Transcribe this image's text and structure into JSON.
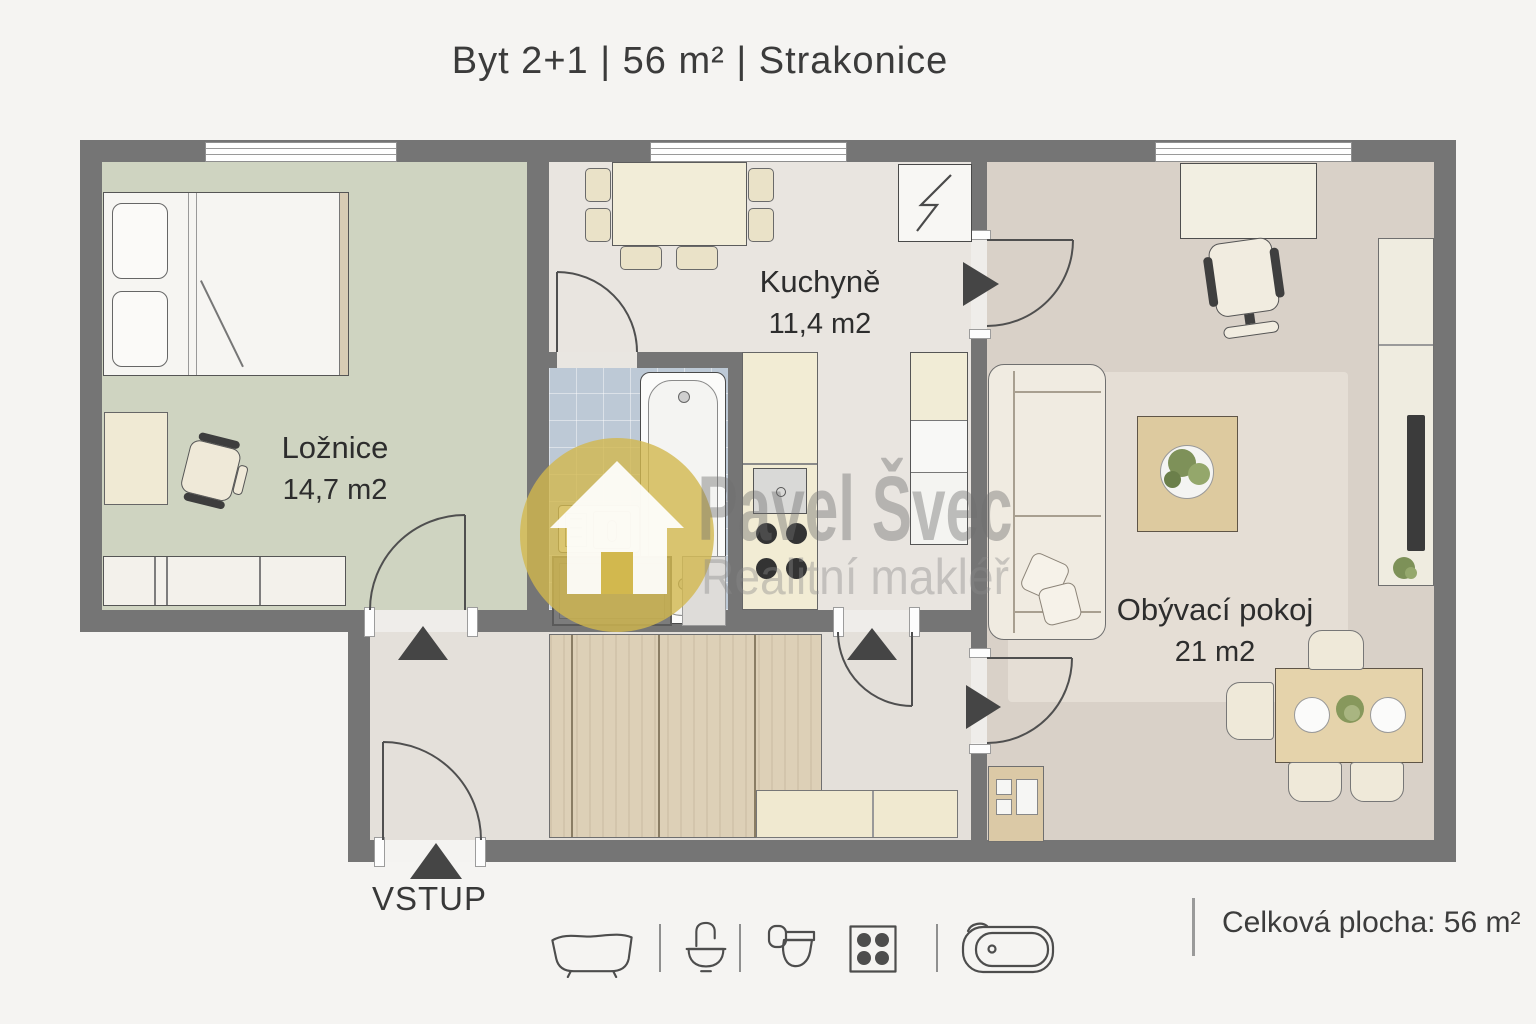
{
  "title": "Byt 2+1 | 56 m² | Strakonice",
  "rooms": [
    {
      "id": "loznice",
      "name": "Ložnice",
      "area": "14,7 m2"
    },
    {
      "id": "kuchyne",
      "name": "Kuchyně",
      "area": "11,4 m2"
    },
    {
      "id": "obyvaci-pokoj",
      "name": "Obývací pokoj",
      "area": "21 m2"
    }
  ],
  "entrance_label": "VSTUP",
  "footer": {
    "total_area": "Celková plocha: 56 m²",
    "legend_icons": [
      "bathtub-side-icon",
      "washbasin-icon",
      "toilet-icon",
      "stove-hob-icon",
      "bathtub-top-icon"
    ]
  },
  "watermark": {
    "name": "Pavel Švec",
    "subtitle": "Realitní makléř",
    "badge": "house-icon",
    "accent_color": "#d2b84e",
    "text_color": "#8a8a8a"
  },
  "colors": {
    "wall": "#757575",
    "bedroom_floor": "#cfd4c1",
    "kitchen_floor": "#e9e5e0",
    "bathroom_floor": "#bdc9d6",
    "hall_floor": "#e4e0da",
    "living_floor": "#d9d1c8",
    "wood": "#ddd0b7",
    "furniture_cream": "#f2edd8"
  }
}
